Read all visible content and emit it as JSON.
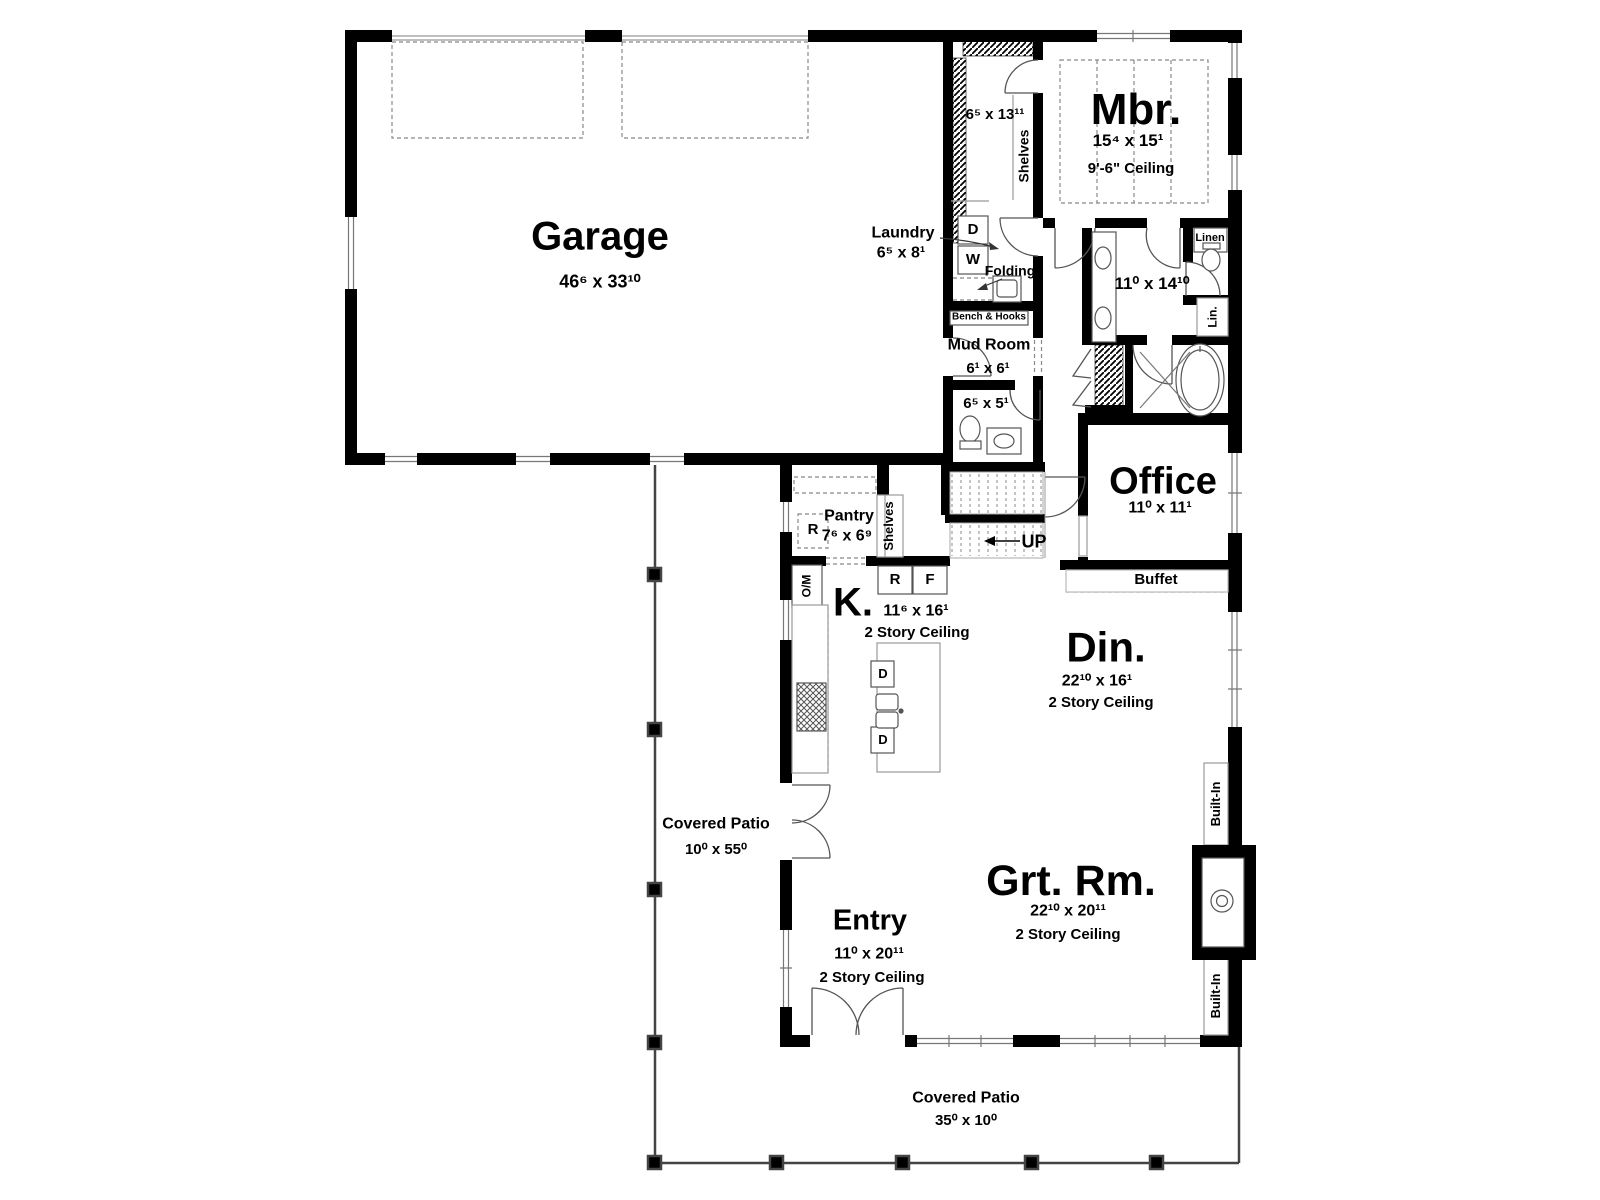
{
  "rooms": {
    "garage": {
      "name": "Garage",
      "dims": "46⁶ x 33¹⁰"
    },
    "laundry": {
      "name": "Laundry",
      "dims": "6⁵ x 8¹",
      "dryer_label": "D",
      "washer_label": "W",
      "folding_label": "Folding"
    },
    "master_closet": {
      "dims": "6⁵ x 13¹¹",
      "shelves_label": "Shelves"
    },
    "master_bedroom": {
      "name": "Mbr.",
      "dims": "15⁴ x 15¹",
      "ceiling": "9'-6\" Ceiling"
    },
    "master_bath": {
      "dims": "11⁰ x 14¹⁰",
      "linen_label": "Linen",
      "linen2_label": "Lin."
    },
    "mud_room": {
      "name": "Mud Room",
      "dims": "6¹ x 6¹",
      "bench_label": "Bench & Hooks"
    },
    "powder_room": {
      "dims": "6⁵ x 5¹"
    },
    "stairs": {
      "up_label": "UP"
    },
    "office": {
      "name": "Office",
      "dims": "11⁰ x 11¹",
      "buffet_label": "Buffet"
    },
    "pantry": {
      "name": "Pantry",
      "dims": "7⁶ x 6⁹",
      "fridge_label": "R",
      "shelves_label": "Shelves",
      "oven_microwave_label": "O/M"
    },
    "kitchen": {
      "name": "K.",
      "dims": "11⁶ x 16¹",
      "ceiling": "2 Story Ceiling",
      "fridge_label": "R",
      "freezer_label": "F",
      "dishwasher1_label": "D",
      "dishwasher2_label": "D"
    },
    "dining": {
      "name": "Din.",
      "dims": "22¹⁰ x 16¹",
      "ceiling": "2 Story Ceiling"
    },
    "great_room": {
      "name": "Grt. Rm.",
      "dims": "22¹⁰ x 20¹¹",
      "ceiling": "2 Story Ceiling",
      "built_in_top_label": "Built-In",
      "built_in_bottom_label": "Built-In"
    },
    "entry": {
      "name": "Entry",
      "dims": "11⁰ x 20¹¹",
      "ceiling": "2 Story Ceiling"
    },
    "side_patio": {
      "name": "Covered Patio",
      "dims": "10⁰ x 55⁰"
    },
    "rear_patio": {
      "name": "Covered Patio",
      "dims": "35⁰ x 10⁰"
    }
  },
  "colors": {
    "walls": "#000000",
    "background": "#ffffff",
    "thin_line": "#555555",
    "dashed_line": "#888888"
  }
}
